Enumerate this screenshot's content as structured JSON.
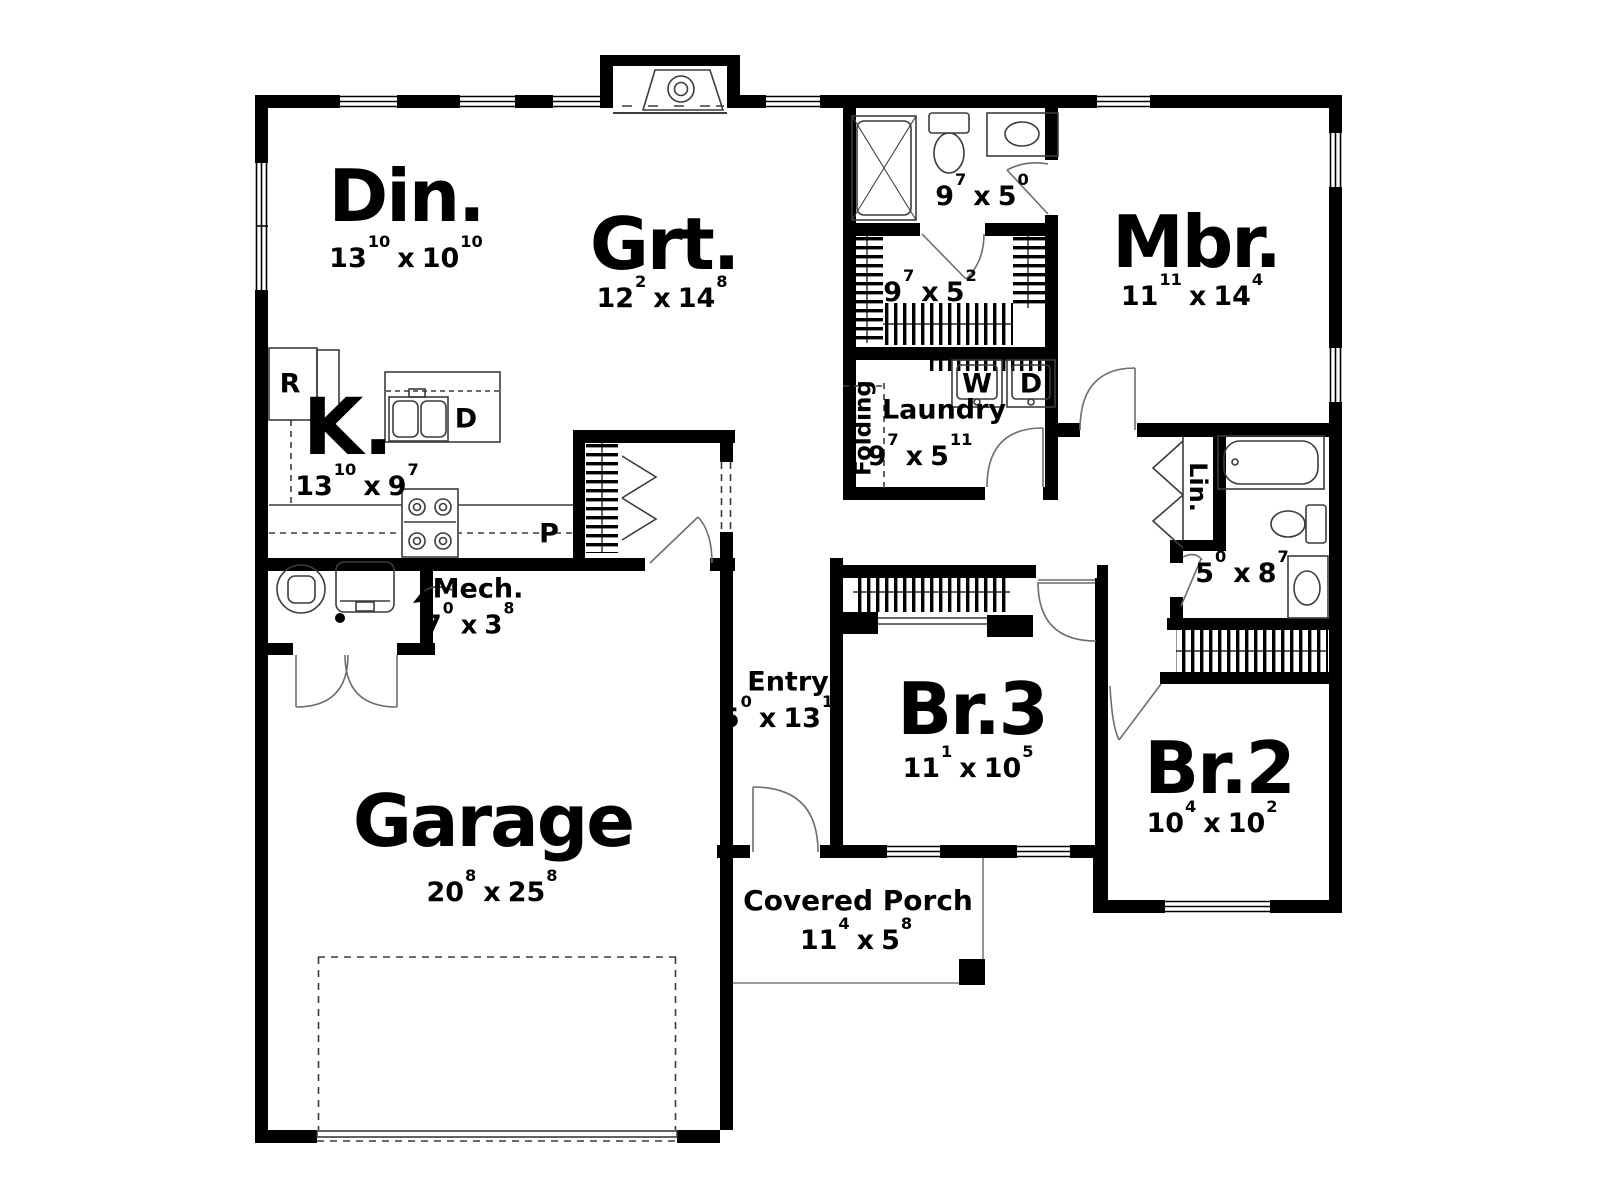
{
  "sep": "x",
  "colors": {
    "wall": "#000000",
    "line": "#3c3c3c",
    "door": "#6e6e6e",
    "bg": "#ffffff"
  },
  "rooms": [
    {
      "id": "din",
      "label": "Din.",
      "f1": "13",
      "i1": "10",
      "f2": "10",
      "i2": "10"
    },
    {
      "id": "grt",
      "label": "Grt.",
      "f1": "12",
      "i1": "2",
      "f2": "14",
      "i2": "8"
    },
    {
      "id": "mbr",
      "label": "Mbr.",
      "f1": "11",
      "i1": "11",
      "f2": "14",
      "i2": "4"
    },
    {
      "id": "kitchen",
      "label": "K.",
      "f1": "13",
      "i1": "10",
      "f2": "9",
      "i2": "7"
    },
    {
      "id": "mbath",
      "label": "",
      "f1": "9",
      "i1": "7",
      "f2": "5",
      "i2": "0"
    },
    {
      "id": "wic",
      "label": "",
      "f1": "9",
      "i1": "7",
      "f2": "5",
      "i2": "2"
    },
    {
      "id": "laundry",
      "label": "Laundry",
      "f1": "9",
      "i1": "7",
      "f2": "5",
      "i2": "11"
    },
    {
      "id": "mech",
      "label": "Mech.",
      "f1": "7",
      "i1": "0",
      "f2": "3",
      "i2": "8"
    },
    {
      "id": "entry",
      "label": "Entry",
      "f1": "5",
      "i1": "0",
      "f2": "13",
      "i2": "1"
    },
    {
      "id": "br3",
      "label": "Br.3",
      "f1": "11",
      "i1": "1",
      "f2": "10",
      "i2": "5"
    },
    {
      "id": "br2",
      "label": "Br.2",
      "f1": "10",
      "i1": "4",
      "f2": "10",
      "i2": "2"
    },
    {
      "id": "hallbath",
      "label": "",
      "f1": "5",
      "i1": "0",
      "f2": "8",
      "i2": "7"
    },
    {
      "id": "garage",
      "label": "Garage",
      "f1": "20",
      "i1": "8",
      "f2": "25",
      "i2": "8"
    },
    {
      "id": "porch",
      "label": "Covered Porch",
      "f1": "11",
      "i1": "4",
      "f2": "5",
      "i2": "8"
    }
  ],
  "tags": {
    "fridge": "R",
    "dishwasher": "D",
    "washer": "W",
    "dryer": "D",
    "pantry": "P",
    "linen": "Lin.",
    "folding": "Folding"
  }
}
